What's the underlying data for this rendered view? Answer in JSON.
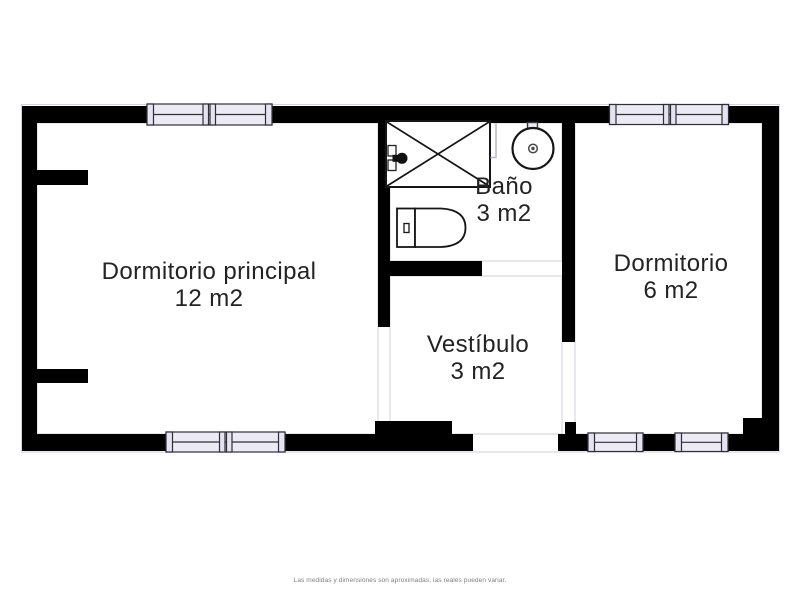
{
  "rooms": [
    {
      "name": "Dormitorio principal",
      "area": "12 m2"
    },
    {
      "name": "Baño",
      "area": "3 m2"
    },
    {
      "name": "Dormitorio",
      "area": "6 m2"
    },
    {
      "name": "Vestíbulo",
      "area": "3 m2"
    }
  ],
  "footer": {
    "disclaimer": "Las medidas y dimensiones son aproximadas, las reales pueden variar."
  },
  "fixtures": [
    "shower",
    "sink",
    "toilet"
  ],
  "colors": {
    "wall": "#000000",
    "window_fill": "#ecebf5",
    "window_frame": "#2e2e36",
    "room_text": "#232323",
    "disclaimer_text": "#7f7f7f",
    "interior_outline": "#d2d2da"
  }
}
